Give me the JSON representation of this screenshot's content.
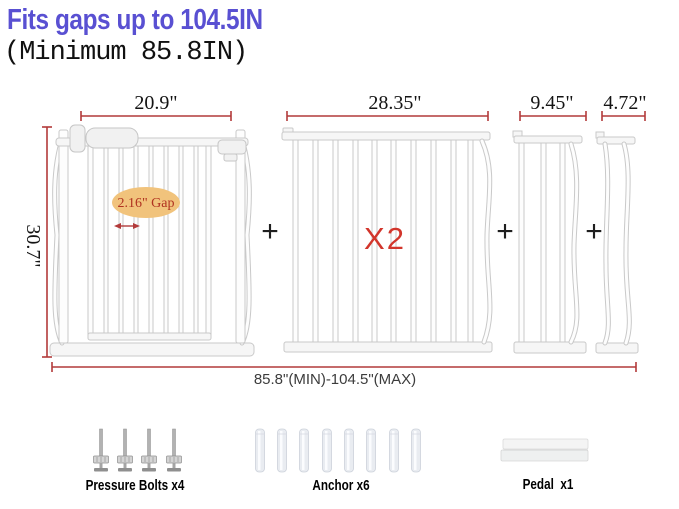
{
  "header": {
    "title": "Fits gaps up to 104.5IN",
    "subtitle": "(Minimum 85.8IN)"
  },
  "diagram": {
    "plus_sign": "+",
    "total_range_label": "85.8\"(MIN)-104.5\"(MAX)",
    "panels": [
      {
        "id": "main-door-gate",
        "width_label": "20.9\"",
        "height_label": "30.7\"",
        "gap_label": "2.16\" Gap"
      },
      {
        "id": "extension-panel-28",
        "width_label": "28.35\"",
        "multiplier": "X2"
      },
      {
        "id": "extension-panel-9",
        "width_label": "9.45\""
      },
      {
        "id": "extension-panel-4",
        "width_label": "4.72\""
      }
    ]
  },
  "accessories": {
    "items": [
      {
        "name": "pressure-bolts",
        "label": "Pressure Bolts x4"
      },
      {
        "name": "anchors",
        "label": "Anchor x6"
      },
      {
        "name": "pedal",
        "label": "Pedal  x1"
      }
    ]
  },
  "colors": {
    "title-blue": "#5950d2",
    "dim-red": "#b23a3a",
    "x2-red": "#d2352b",
    "gap-text-red": "#b03220",
    "gap-ellipse-tan": "#f1c37c",
    "total-text-gray": "#3c3c3c"
  }
}
